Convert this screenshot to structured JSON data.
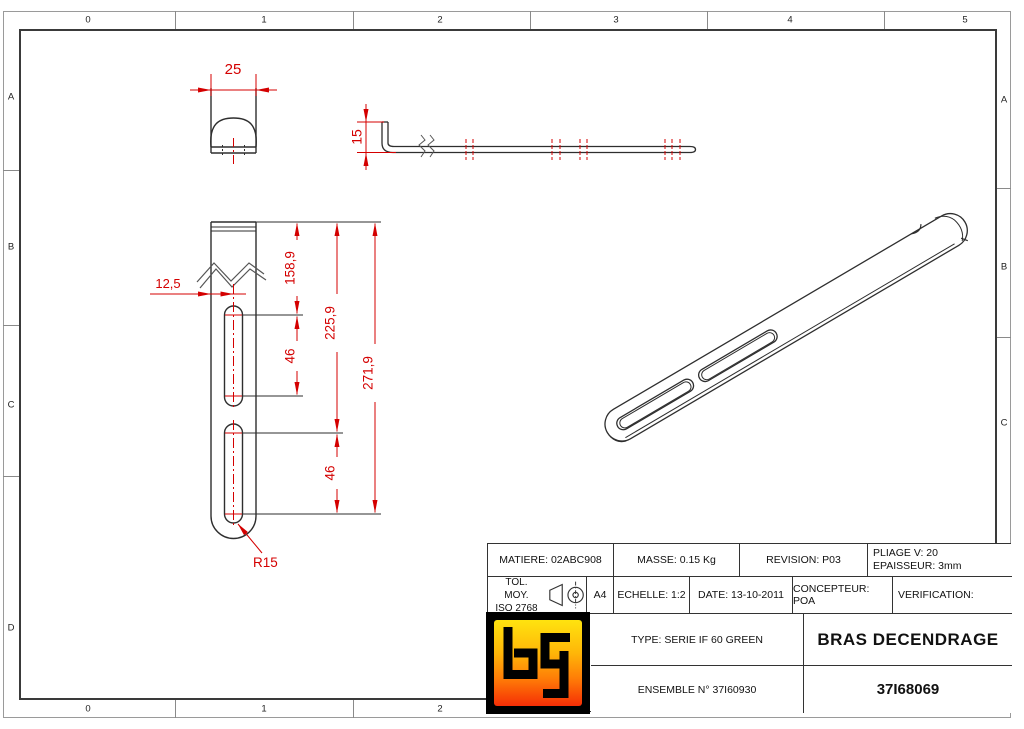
{
  "border": {
    "top_labels": [
      "0",
      "1",
      "2",
      "3",
      "4",
      "5"
    ],
    "bottom_labels": [
      "0",
      "1",
      "2"
    ],
    "left_labels": [
      "A",
      "B",
      "C",
      "D"
    ],
    "right_labels": [
      "A",
      "B",
      "C"
    ]
  },
  "dimensions": {
    "width": "25",
    "flange_height": "15",
    "edge_offset": "12,5",
    "slot1_top": "158,9",
    "slot2_top": "225,9",
    "total_length": "271,9",
    "slot1_length": "46",
    "slot2_length": "46",
    "end_radius": "R15"
  },
  "title_block": {
    "matiere": "MATIERE: 02ABC908",
    "masse": "MASSE: 0.15 Kg",
    "revision": "REVISION: P03",
    "pliage": "PLIAGE V: 20",
    "epaisseur": "EPAISSEUR: 3mm",
    "tol_line1": "TOL. MOY.",
    "tol_line2": "ISO 2768",
    "format": "A4",
    "echelle": "ECHELLE: 1:2",
    "date": "DATE: 13-10-2011",
    "concepteur": "CONCEPTEUR: POA",
    "verification": "VERIFICATION:",
    "type": "TYPE: SERIE IF 60 GREEN",
    "title": "BRAS DECENDRAGE",
    "ensemble": "ENSEMBLE N° 37I60930",
    "part_number": "37I68069",
    "logo_letters": "bg"
  },
  "colors": {
    "dimension_red": "#d40000",
    "object_line": "#2e2e2e"
  }
}
